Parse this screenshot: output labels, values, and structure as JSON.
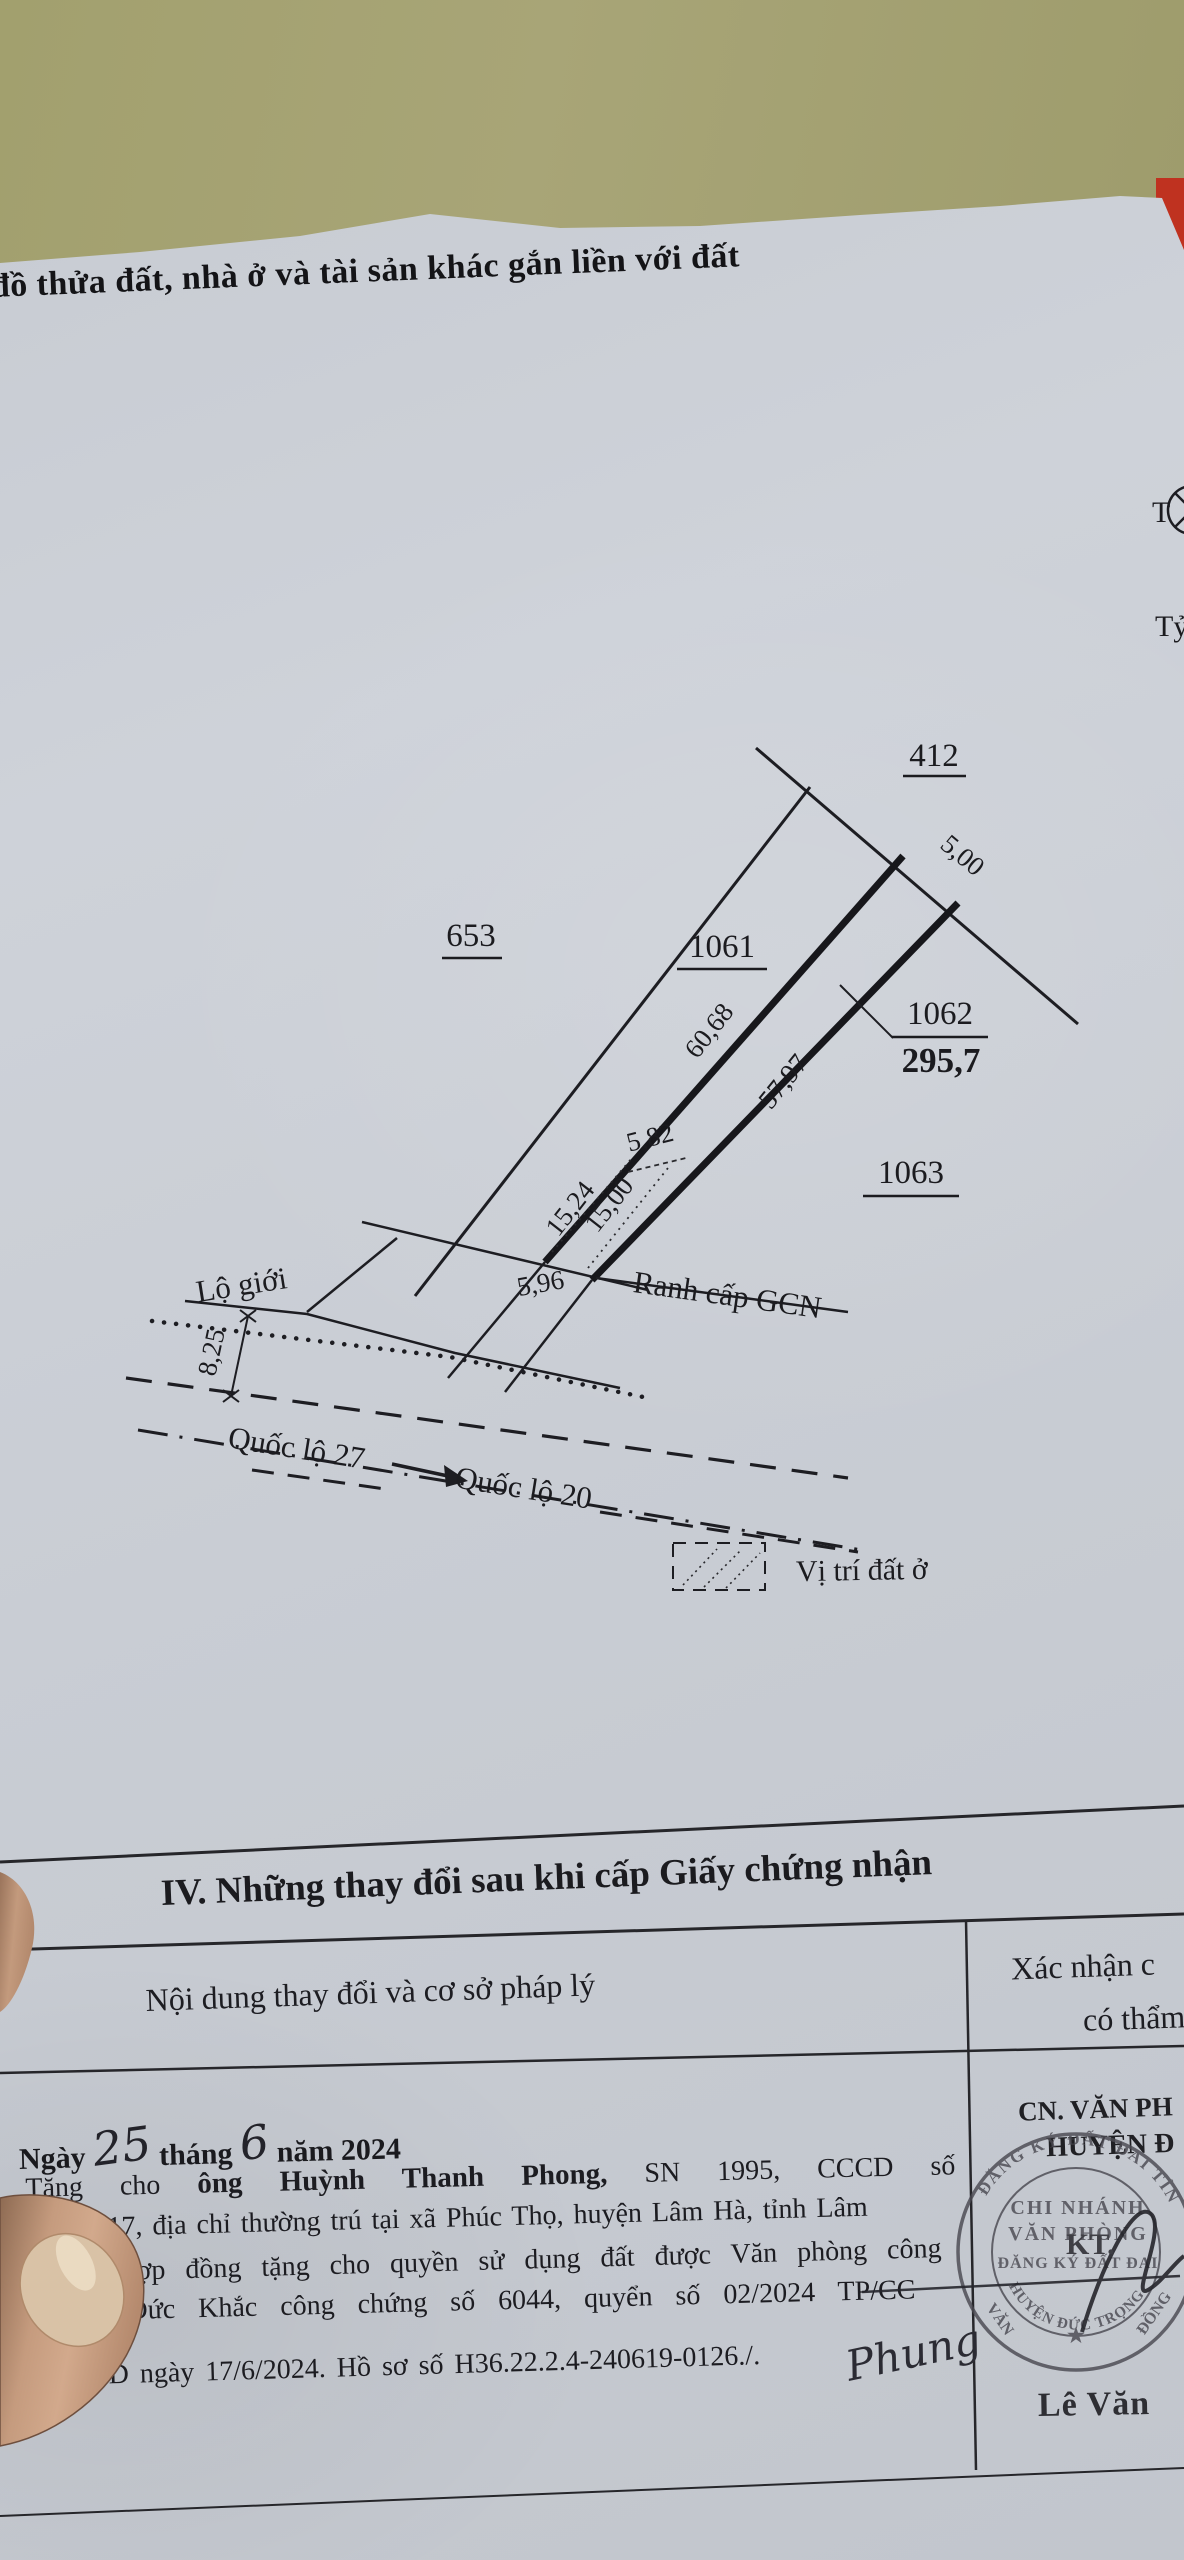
{
  "scene": {
    "table_color": "#a5a272",
    "paper_color": "#c9cdd4",
    "red_object_color": "#bf3220"
  },
  "title": "đồ thửa đất, nhà ở và tài sản khác gắn liền với đất",
  "compass_label": "T",
  "scale_label": "Tỷ",
  "map": {
    "parcel_412": "412",
    "parcel_653": "653",
    "parcel_1061": "1061",
    "parcel_1062": "1062",
    "area_1062": "295,7",
    "parcel_1063": "1063",
    "dim_5_00": "5,00",
    "dim_60_68": "60,68",
    "dim_57_97": "57,97",
    "dim_5_82": "5,82",
    "dim_15_24": "15,24",
    "dim_15_00": "15,00",
    "dim_5_96": "5,96",
    "dim_8_25": "8,25",
    "label_lo_gioi": "Lộ giới",
    "label_ranh": "Ranh cấp GCN",
    "label_ql27": "Quốc lộ 27",
    "label_ql20": "Quốc lộ 20",
    "legend_label": "Vị trí đất ở"
  },
  "section": {
    "heading": "IV. Những thay đổi sau khi cấp Giấy chứng nhận",
    "col_content": "Nội dung thay đổi và cơ sở pháp lý",
    "col_confirm_1": "Xác nhận c",
    "col_confirm_2": "có thẩm"
  },
  "entry": {
    "date_prefix": "Ngày",
    "date_day": "25",
    "date_month_label": "tháng",
    "date_month": "6",
    "date_year_label": "năm 2024",
    "line1_start": "Tặng cho ",
    "line1_bold": "ông Huỳnh Thanh Phong,",
    "line1_end": " SN 1995, CCCD số",
    "line2": "717, địa chỉ thường trú tại xã Phúc Thọ, huyện Lâm Hà, tỉnh Lâm",
    "line3": "Hợp đồng tặng cho quyền sử dụng đất được Văn phòng công",
    "line4": "n Đức Khắc công chứng số 6044, quyển số 02/2024 TP/CC",
    "line5": "GD ngày 17/6/2024. Hồ sơ số H36.22.2.4-240619-0126./.",
    "handwritten_sign": "Phung"
  },
  "approval": {
    "office_line1": "CN. VĂN PH",
    "office_line2": "HUYỆN Đ",
    "kt": "KT.",
    "name": "Lê Văn",
    "stamp_arc_top": "ĐĂNG KÝ ĐẤT ĐAI TỈNH",
    "stamp_line1": "CHI NHÁNH",
    "stamp_line2": "VĂN PHÒNG",
    "stamp_line3": "ĐĂNG KÝ ĐẤT ĐAI",
    "stamp_arc_bottom": "HUYỆN ĐỨC TRỌNG",
    "stamp_left": "VĂN",
    "stamp_right": "ĐỒNG",
    "stamp_star": "★"
  }
}
